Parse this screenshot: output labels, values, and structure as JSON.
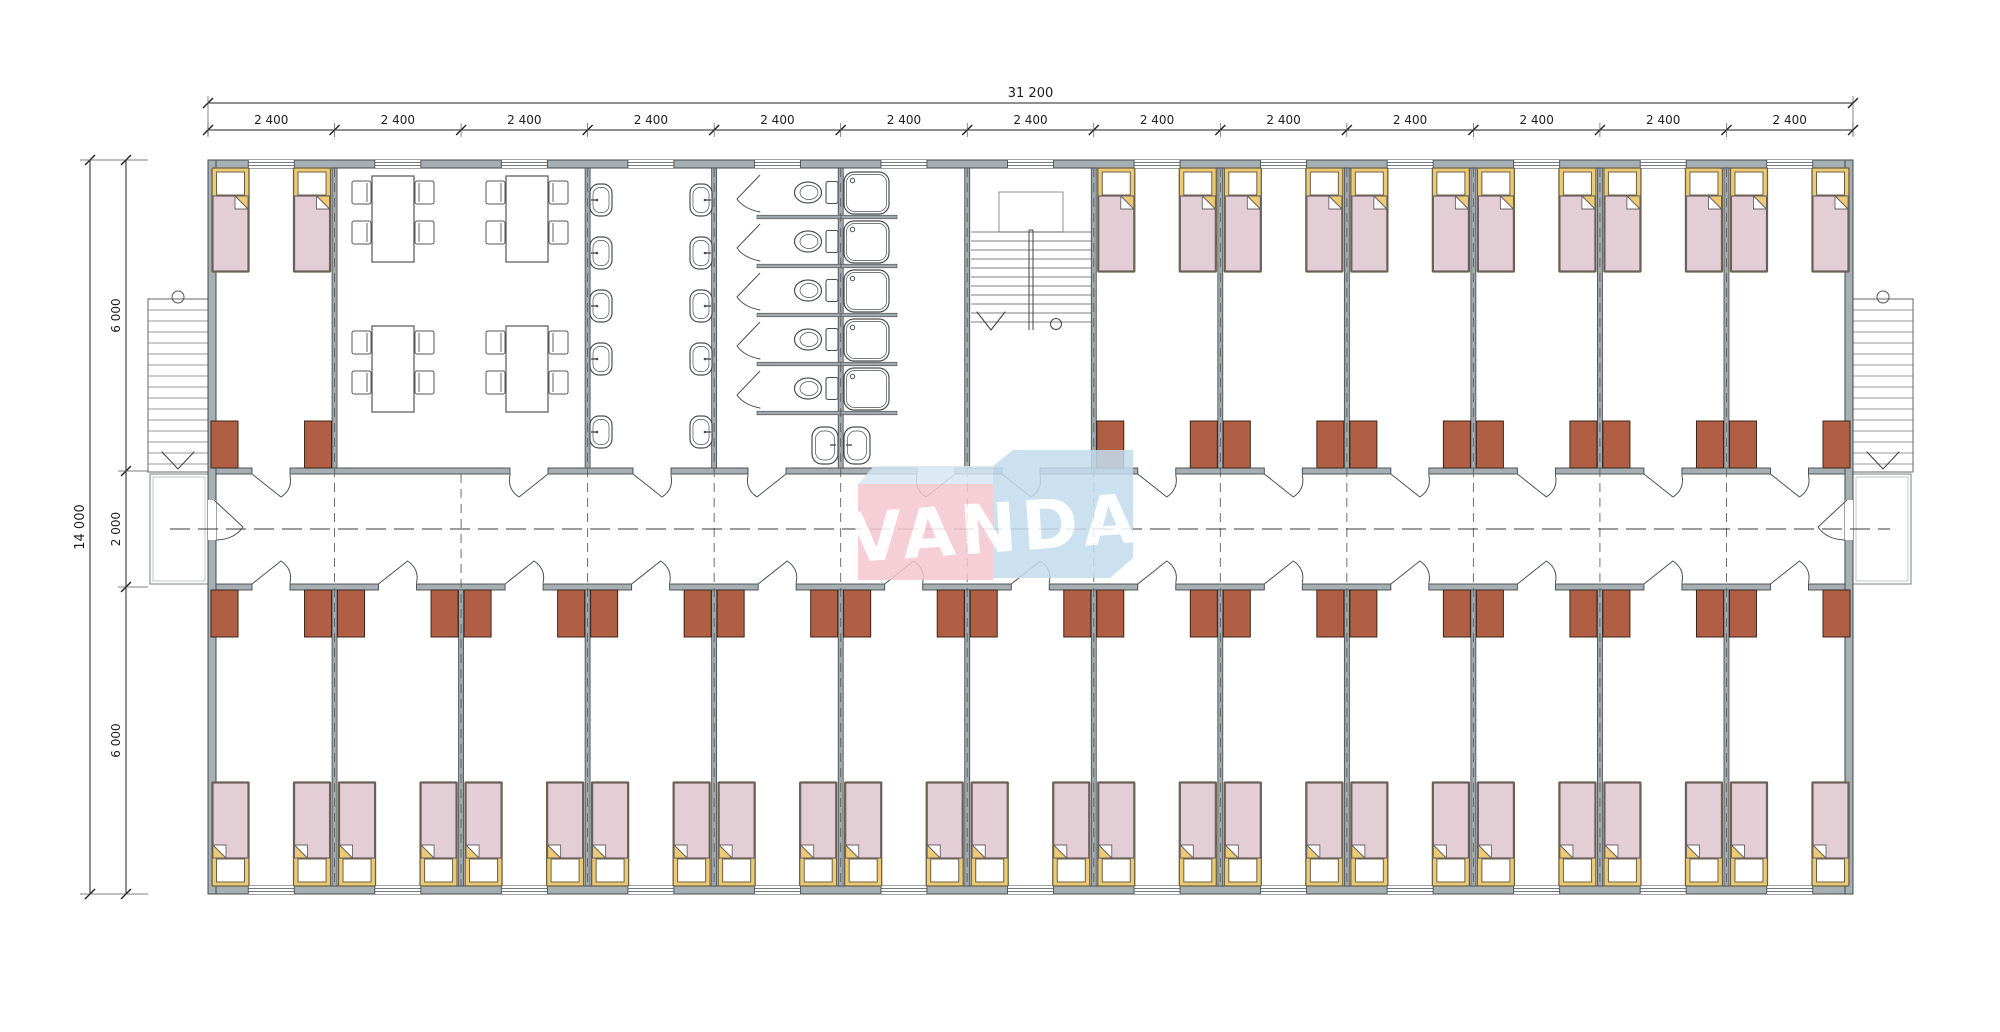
{
  "watermark": {
    "text": "VANDA",
    "pink_block": "#f5c7cf",
    "blue_block": "#c4dcee",
    "fold": "#d6e7f4",
    "text_color": "#ffffff"
  },
  "dimensions": {
    "top": {
      "overall": "31 200",
      "bays": [
        "2 400",
        "2 400",
        "2 400",
        "2 400",
        "2 400",
        "2 400",
        "2 400",
        "2 400",
        "2 400",
        "2 400",
        "2 400",
        "2 400",
        "2 400"
      ]
    },
    "left": {
      "overall": "14 000",
      "segments": [
        "6 000",
        "2 000",
        "6 000"
      ]
    }
  },
  "colors": {
    "wall": "#a6afb3",
    "wall_stroke": "#43484b",
    "partition": "#9fa9ad",
    "line": "#4c5154",
    "thin": "#6d7477",
    "bed_frame": "#eccb74",
    "bed_frame_stroke": "#6b6145",
    "mattress": "#e3ced5",
    "mattress_stroke": "#6b6065",
    "desk": "#b05f45",
    "desk_stroke": "#3d2417",
    "centerline": "#3a3a3a",
    "axis": "#5a5f62",
    "dim_text": "#1d1d1d",
    "fixture_stroke": "#4a4f52",
    "white": "#ffffff"
  },
  "plan": {
    "bays": 13,
    "top_zone": [
      {
        "type": "bedroom",
        "bays": [
          1
        ]
      },
      {
        "type": "dining-room",
        "bays": [
          2,
          3
        ],
        "tables": 4,
        "chairs_per_table": 4
      },
      {
        "type": "washroom",
        "bays": [
          4
        ],
        "sinks": 10
      },
      {
        "type": "toilet-room",
        "bays": [
          5
        ],
        "stalls": 5
      },
      {
        "type": "shower-room",
        "bays": [
          6
        ],
        "stalls": 5
      },
      {
        "type": "stair-hall",
        "bays": [
          7
        ]
      },
      {
        "type": "bedrooms",
        "bays": [
          8,
          9,
          10,
          11,
          12,
          13
        ]
      }
    ],
    "bottom_zone": {
      "type": "bedrooms",
      "rooms": 13
    },
    "beds_per_bedroom": 2,
    "desks_per_bedroom": 2,
    "external_stairs": 2,
    "extra_sinks_pair": 2,
    "corridor_position": "center"
  }
}
